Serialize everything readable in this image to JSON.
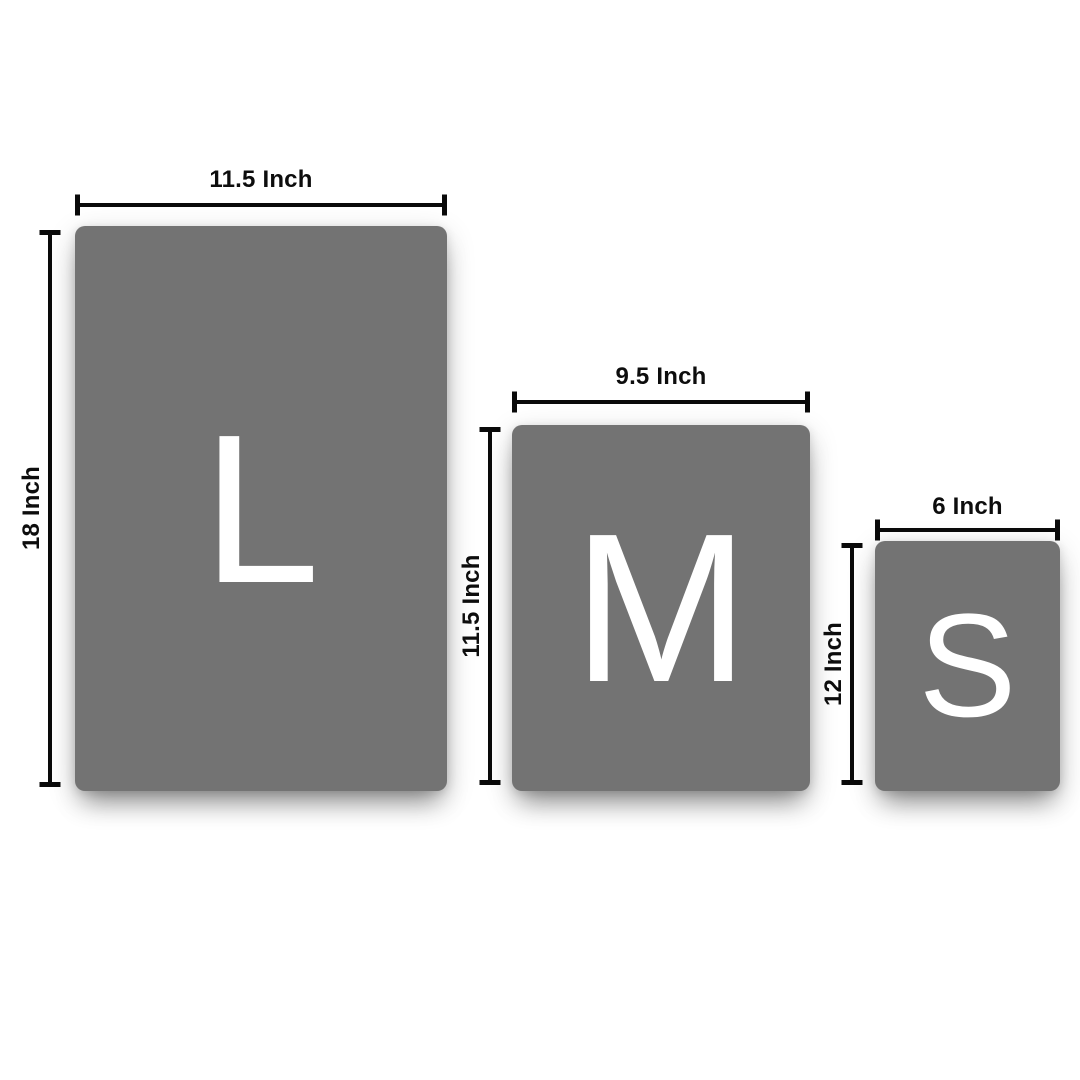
{
  "colors": {
    "panel": "#737373",
    "letter": "#ffffff",
    "dimension_line": "#0a0a0a",
    "label_text": "#0d0d0d",
    "background": "#ffffff"
  },
  "sizes": [
    {
      "letter": "L",
      "width_label": "11.5 Inch",
      "height_label": "18 Inch"
    },
    {
      "letter": "M",
      "width_label": "9.5 Inch",
      "height_label": "11.5 Inch"
    },
    {
      "letter": "S",
      "width_label": "6 Inch",
      "height_label": "12 Inch"
    }
  ]
}
